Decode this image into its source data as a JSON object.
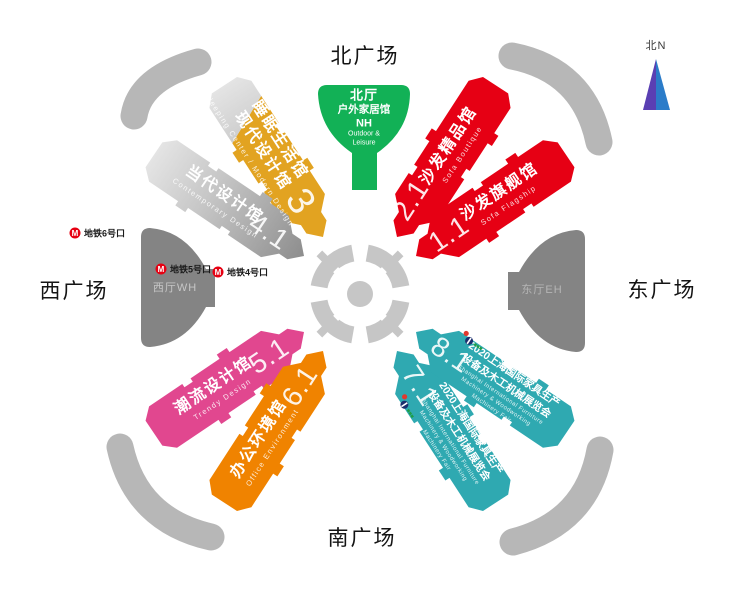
{
  "plazas": {
    "north": "北广场",
    "west": "西广场",
    "east": "东广场",
    "south": "南广场"
  },
  "compass": {
    "label": "北N",
    "icon": "north-arrow-icon",
    "color_left": "#5a3fb3",
    "color_right": "#2b7cc9"
  },
  "halls": [
    {
      "number": "3",
      "name_cn_1": "睡眠生活馆",
      "name_cn_2": "现代设计馆",
      "name_en": "Sleeping Center / Modern Design",
      "color": "#e2a321",
      "color_secondary": "silver"
    },
    {
      "number": "4.1",
      "name_cn_1": "当代设计馆",
      "name_en": "Contemporary Design",
      "color": "#c0c0c0"
    },
    {
      "number": "2.1",
      "name_cn_1": "沙发精品馆",
      "name_en": "Sofa Boutique",
      "color": "#e60014"
    },
    {
      "number": "1.1",
      "name_cn_1": "沙发旗舰馆",
      "name_en": "Sofa Flagship",
      "color": "#e60014"
    },
    {
      "number": "5.1",
      "name_cn_1": "潮流设计馆",
      "name_en": "Trendy Design",
      "color": "#e1478f"
    },
    {
      "number": "6.1",
      "name_cn_1": "办公环境馆",
      "name_en": "Office Environment",
      "color": "#f08300"
    },
    {
      "number": "8.1",
      "name_cn_1": "2020上海国际家具生产",
      "name_cn_2": "设备及木工机械展览会",
      "name_en_1": "Shanghai International Furniture",
      "name_en_2": "Machinery & Woodworking",
      "name_en_3": "Machinery Fair",
      "color": "#2fa9b1",
      "logo_icon": "fair-logo"
    },
    {
      "number": "7.1",
      "name_cn_1": "2020上海国际家具生产",
      "name_cn_2": "设备及木工机械展览会",
      "name_en_1": "Shanghai International Furniture",
      "name_en_2": "Machinery & Woodworking",
      "name_en_3": "Machinery Fair",
      "color": "#2fa9b1",
      "logo_icon": "fair-logo"
    }
  ],
  "entrances": {
    "north": {
      "line1": "北厅",
      "line2": "户外家居馆",
      "line3": "NH",
      "line4": "Outdoor &",
      "line5": "Leisure",
      "color": "#12b156"
    },
    "west": {
      "label": "西厅WH",
      "color": "#848484"
    },
    "east": {
      "label": "东厅EH",
      "color": "#848484"
    }
  },
  "metro_exits": [
    {
      "label": "地铁6号口",
      "icon": "metro-icon"
    },
    {
      "label": "地铁5号口",
      "icon": "metro-icon"
    },
    {
      "label": "地铁4号口",
      "icon": "metro-icon"
    }
  ],
  "colors": {
    "metro": "#e60012",
    "ring": "#c6c6c6",
    "ramp": "#b7b7b7",
    "silver_light": "#e6e6e6",
    "silver_dark": "#8d8d8d"
  }
}
